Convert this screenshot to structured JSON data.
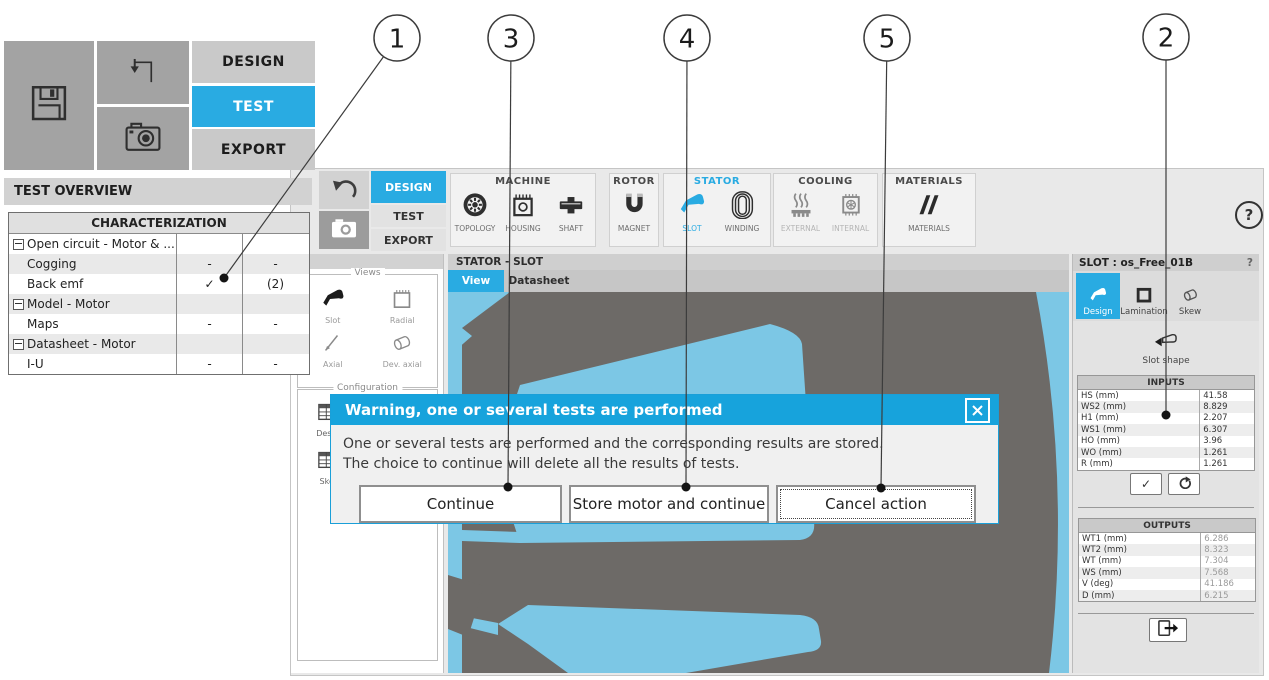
{
  "colors": {
    "accent": "#29abe2",
    "dialog_header": "#17a3dc",
    "canvas_blue": "#7cc7e5",
    "lamination_gray": "#6d6a67"
  },
  "overlay_panel": {
    "tabs": [
      {
        "label": "DESIGN",
        "active": false
      },
      {
        "label": "TEST",
        "active": true
      },
      {
        "label": "EXPORT",
        "active": false
      }
    ],
    "icons": [
      "save-icon",
      "import-arrow-icon",
      "camera-icon"
    ],
    "test_overview": {
      "title": "TEST OVERVIEW",
      "table_header": "CHARACTERIZATION",
      "rows": [
        {
          "label": "Open circuit - Motor & ...",
          "group": true,
          "c1": "",
          "c2": ""
        },
        {
          "label": "Cogging",
          "group": false,
          "c1": "-",
          "c2": "-"
        },
        {
          "label": "Back emf",
          "group": false,
          "c1": "✓",
          "c2": "(2)"
        },
        {
          "label": "Model - Motor",
          "group": true,
          "c1": "",
          "c2": ""
        },
        {
          "label": "Maps",
          "group": false,
          "c1": "-",
          "c2": "-"
        },
        {
          "label": "Datasheet - Motor",
          "group": true,
          "c1": "",
          "c2": ""
        },
        {
          "label": "I-U",
          "group": false,
          "c1": "-",
          "c2": "-"
        }
      ]
    }
  },
  "main_window": {
    "toolbar_icons": [
      "undo-icon",
      "camera-icon"
    ],
    "tabs": [
      {
        "label": "DESIGN",
        "active": true
      },
      {
        "label": "TEST",
        "active": false
      },
      {
        "label": "EXPORT",
        "active": false
      }
    ],
    "help_label": "?",
    "ribbon_groups": [
      {
        "name": "MACHINE",
        "accent": false,
        "items": [
          {
            "label": "TOPOLOGY",
            "icon": "topology-icon",
            "state": "normal"
          },
          {
            "label": "HOUSING",
            "icon": "housing-icon",
            "state": "normal"
          },
          {
            "label": "SHAFT",
            "icon": "shaft-icon",
            "state": "normal"
          }
        ]
      },
      {
        "name": "ROTOR",
        "accent": false,
        "items": [
          {
            "label": "MAGNET",
            "icon": "magnet-icon",
            "state": "normal"
          }
        ]
      },
      {
        "name": "STATOR",
        "accent": true,
        "items": [
          {
            "label": "SLOT",
            "icon": "slot-blue-icon",
            "state": "active"
          },
          {
            "label": "WINDING",
            "icon": "winding-icon",
            "state": "normal"
          }
        ]
      },
      {
        "name": "COOLING",
        "accent": false,
        "items": [
          {
            "label": "EXTERNAL",
            "icon": "external-cooling-icon",
            "state": "disabled"
          },
          {
            "label": "INTERNAL",
            "icon": "internal-cooling-icon",
            "state": "disabled"
          }
        ]
      },
      {
        "name": "MATERIALS",
        "accent": false,
        "items": [
          {
            "label": "MATERIALS",
            "icon": "materials-icon",
            "state": "normal"
          }
        ]
      }
    ]
  },
  "left_panel": {
    "views": {
      "title": "Views",
      "items": [
        {
          "label": "Slot",
          "icon": "slot-dark-icon"
        },
        {
          "label": "Radial",
          "icon": "radial-icon"
        },
        {
          "label": "Axial",
          "icon": "axial-icon"
        },
        {
          "label": "Dev. axial",
          "icon": "dev-axial-icon"
        }
      ]
    },
    "configuration": {
      "title": "Configuration",
      "items": [
        {
          "label": "Design",
          "icon": "table-icon"
        },
        {
          "label": "Skew",
          "icon": "table-icon"
        }
      ]
    }
  },
  "viewer": {
    "title": "STATOR - SLOT",
    "tabs": [
      {
        "label": "View",
        "active": true
      },
      {
        "label": "Datasheet",
        "active": false
      }
    ]
  },
  "slot_panel": {
    "title": "SLOT : os_Free_01B",
    "help_label": "?",
    "tabs": [
      {
        "label": "Design",
        "icon": "slot-white-icon",
        "active": true
      },
      {
        "label": "Lamination",
        "icon": "lamination-icon",
        "active": false
      },
      {
        "label": "Skew",
        "icon": "skew-icon",
        "active": false
      }
    ],
    "tool_label": "Slot shape",
    "inputs": {
      "title": "INPUTS",
      "rows": [
        {
          "label": "HS (mm)",
          "value": "41.58"
        },
        {
          "label": "WS2 (mm)",
          "value": "8.829"
        },
        {
          "label": "H1 (mm)",
          "value": "2.207"
        },
        {
          "label": "WS1 (mm)",
          "value": "6.307"
        },
        {
          "label": "HO (mm)",
          "value": "3.96"
        },
        {
          "label": "WO (mm)",
          "value": "1.261"
        },
        {
          "label": "R (mm)",
          "value": "1.261"
        }
      ]
    },
    "outputs": {
      "title": "OUTPUTS",
      "rows": [
        {
          "label": "WT1 (mm)",
          "value": "6.286"
        },
        {
          "label": "WT2 (mm)",
          "value": "8.323"
        },
        {
          "label": "WT (mm)",
          "value": "7.304"
        },
        {
          "label": "WS (mm)",
          "value": "7.568"
        },
        {
          "label": "V (deg)",
          "value": "41.186"
        },
        {
          "label": "D (mm)",
          "value": "6.215"
        }
      ]
    },
    "action_icons": [
      "apply-check-icon",
      "reset-icon",
      "export-icon"
    ]
  },
  "dialog": {
    "title": "Warning, one or several tests are performed",
    "close_icon": "close-icon",
    "lines": [
      "One or several tests are performed and the corresponding results are stored.",
      "The choice to continue will delete all the results of tests."
    ],
    "buttons": [
      {
        "label": "Continue",
        "width": 199,
        "default": false
      },
      {
        "label": "Store motor and continue",
        "width": 196,
        "default": false
      },
      {
        "label": "Cancel action",
        "width": 196,
        "default": true
      }
    ]
  },
  "callouts": [
    {
      "n": "1",
      "cx": 397,
      "cy": 38,
      "tx": 224,
      "ty": 278
    },
    {
      "n": "3",
      "cx": 511,
      "cy": 38,
      "tx": 508,
      "ty": 487
    },
    {
      "n": "4",
      "cx": 687,
      "cy": 38,
      "tx": 686,
      "ty": 487
    },
    {
      "n": "5",
      "cx": 887,
      "cy": 38,
      "tx": 881,
      "ty": 488
    },
    {
      "n": "2",
      "cx": 1166,
      "cy": 37,
      "tx": 1166,
      "ty": 415
    }
  ]
}
